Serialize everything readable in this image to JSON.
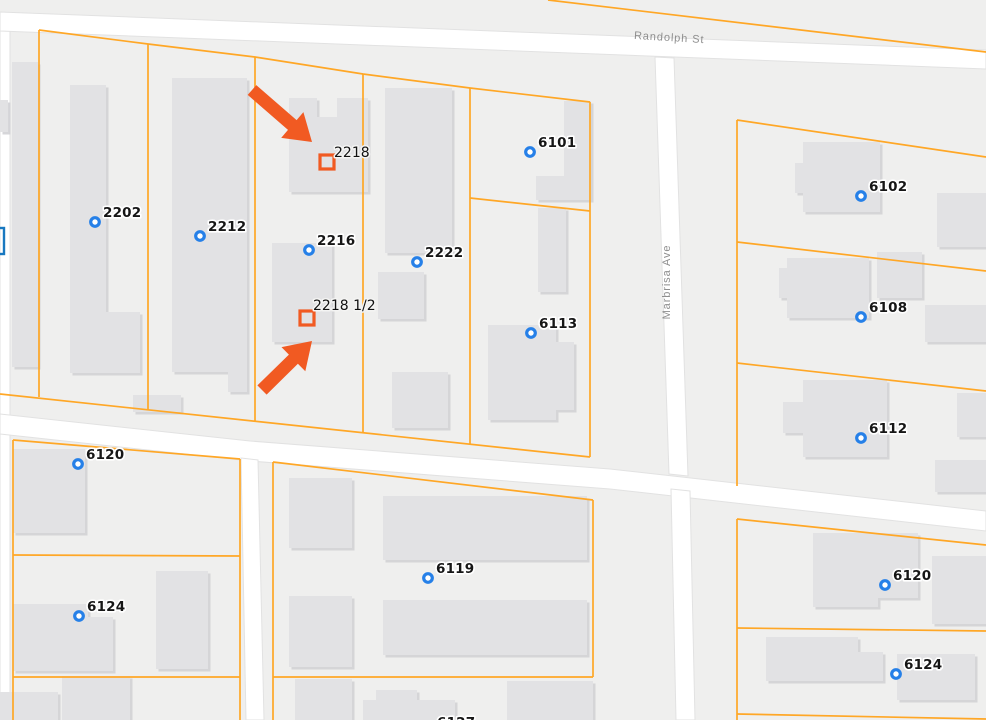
{
  "streets": [
    {
      "name": "Randolph St"
    },
    {
      "name": "Marbrisa Ave"
    }
  ],
  "markers": [
    {
      "label": "2202",
      "x": 95,
      "y": 222
    },
    {
      "label": "2212",
      "x": 200,
      "y": 236
    },
    {
      "label": "2216",
      "x": 309,
      "y": 250
    },
    {
      "label": "2222",
      "x": 417,
      "y": 262
    },
    {
      "label": "6101",
      "x": 530,
      "y": 152
    },
    {
      "label": "6102",
      "x": 861,
      "y": 196
    },
    {
      "label": "6108",
      "x": 861,
      "y": 317
    },
    {
      "label": "6113",
      "x": 531,
      "y": 333
    },
    {
      "label": "6112",
      "x": 861,
      "y": 438
    },
    {
      "label": "6120",
      "x": 78,
      "y": 464
    },
    {
      "label": "6124",
      "x": 79,
      "y": 616
    },
    {
      "label": "6119",
      "x": 428,
      "y": 578
    },
    {
      "label": "6120",
      "x": 885,
      "y": 585
    },
    {
      "label": "6124",
      "x": 896,
      "y": 674
    }
  ],
  "highlights": [
    {
      "label": "2218",
      "cx": 327,
      "cy": 162,
      "label_x": 334,
      "label_y": 157
    },
    {
      "label": "2218 1/2",
      "cx": 307,
      "cy": 318,
      "label_x": 313,
      "label_y": 310
    }
  ],
  "partial_labels": [
    {
      "label": "6127",
      "x": 437,
      "y": 727
    }
  ],
  "colors": {
    "parcel_line": "#ffa726",
    "highlight_orange": "#f15a22",
    "marker_blue": "#2680e8",
    "address_text": "#161616",
    "street_text": "#8e8e8e",
    "building_fill": "#e2e2e4",
    "street_fill": "#ffffff",
    "map_background": "#efefee"
  }
}
